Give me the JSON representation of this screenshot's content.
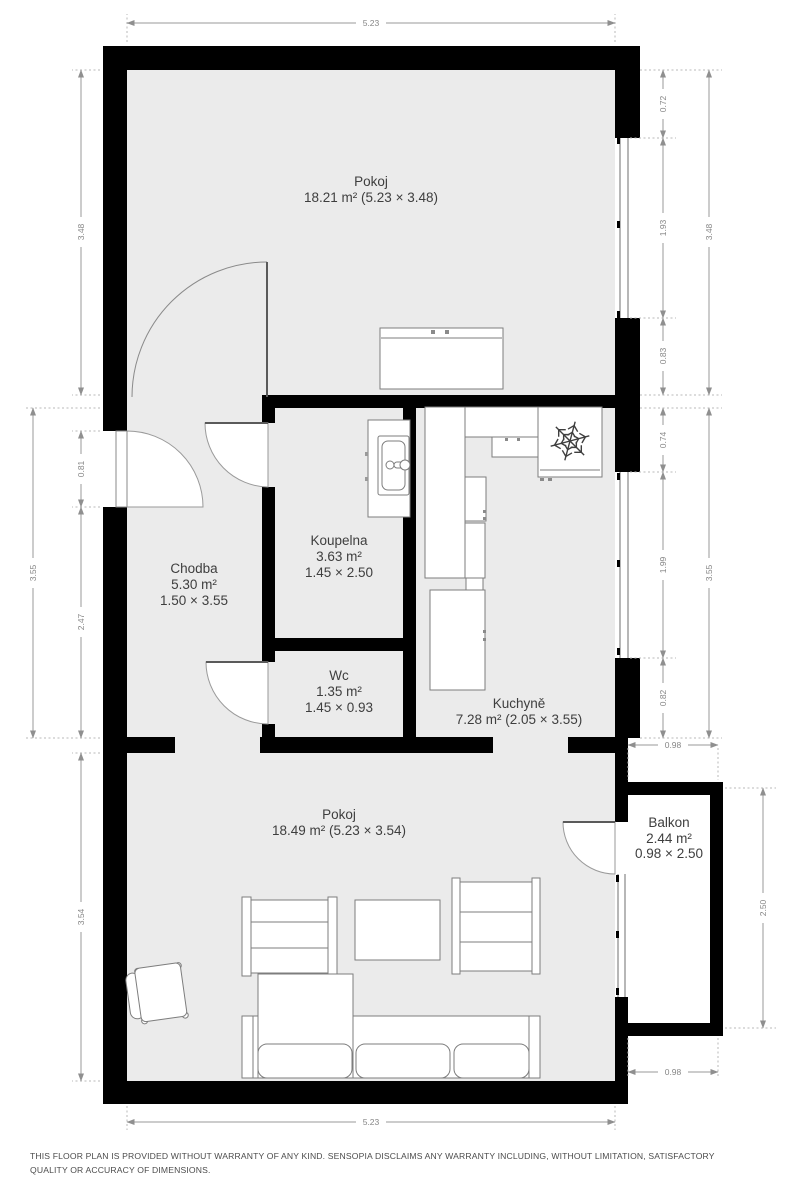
{
  "meta": {
    "floor_color": "#ebebeb",
    "wall_color": "#000000",
    "dimension_color": "#9a9a9a",
    "label_color": "#3e3e3e"
  },
  "rooms": {
    "pokoj_top": {
      "name": "Pokoj",
      "size": "18.21 m² (5.23 × 3.48)"
    },
    "koupelna": {
      "name": "Koupelna",
      "area": "3.63 m²",
      "size": "1.45 × 2.50"
    },
    "chodba": {
      "name": "Chodba",
      "area": "5.30 m²",
      "size": "1.50 × 3.55"
    },
    "wc": {
      "name": "Wc",
      "area": "1.35 m²",
      "size": "1.45 × 0.93"
    },
    "kuchyne": {
      "name": "Kuchyně",
      "size": "7.28 m² (2.05 × 3.55)"
    },
    "pokoj_bottom": {
      "name": "Pokoj",
      "size": "18.49 m² (5.23 × 3.54)"
    },
    "balkon": {
      "name": "Balkon",
      "area": "2.44 m²",
      "size": "0.98 × 2.50"
    }
  },
  "dimensions": {
    "top_width": "5.23",
    "bottom_width": "5.23",
    "left": {
      "upper_total": "3.48",
      "entry_door": "0.81",
      "hall_lower": "2.47",
      "middle_total": "3.55",
      "lower_total": "3.54"
    },
    "right": {
      "upper_seg1": "0.72",
      "upper_window": "1.93",
      "upper_seg2": "0.83",
      "upper_total": "3.48",
      "mid_seg1": "0.74",
      "mid_window": "1.99",
      "mid_seg2": "0.82",
      "mid_total": "3.55"
    },
    "balcony": {
      "top_width": "0.98",
      "right_depth": "2.50",
      "bottom_width": "0.98"
    }
  },
  "icons": {
    "freezer_badge": "snowflake-icon"
  },
  "footer": {
    "disclaimer": "THIS FLOOR PLAN IS PROVIDED WITHOUT WARRANTY OF ANY KIND. SENSOPIA DISCLAIMS ANY WARRANTY INCLUDING, WITHOUT LIMITATION, SATISFACTORY QUALITY OR ACCURACY OF DIMENSIONS."
  }
}
